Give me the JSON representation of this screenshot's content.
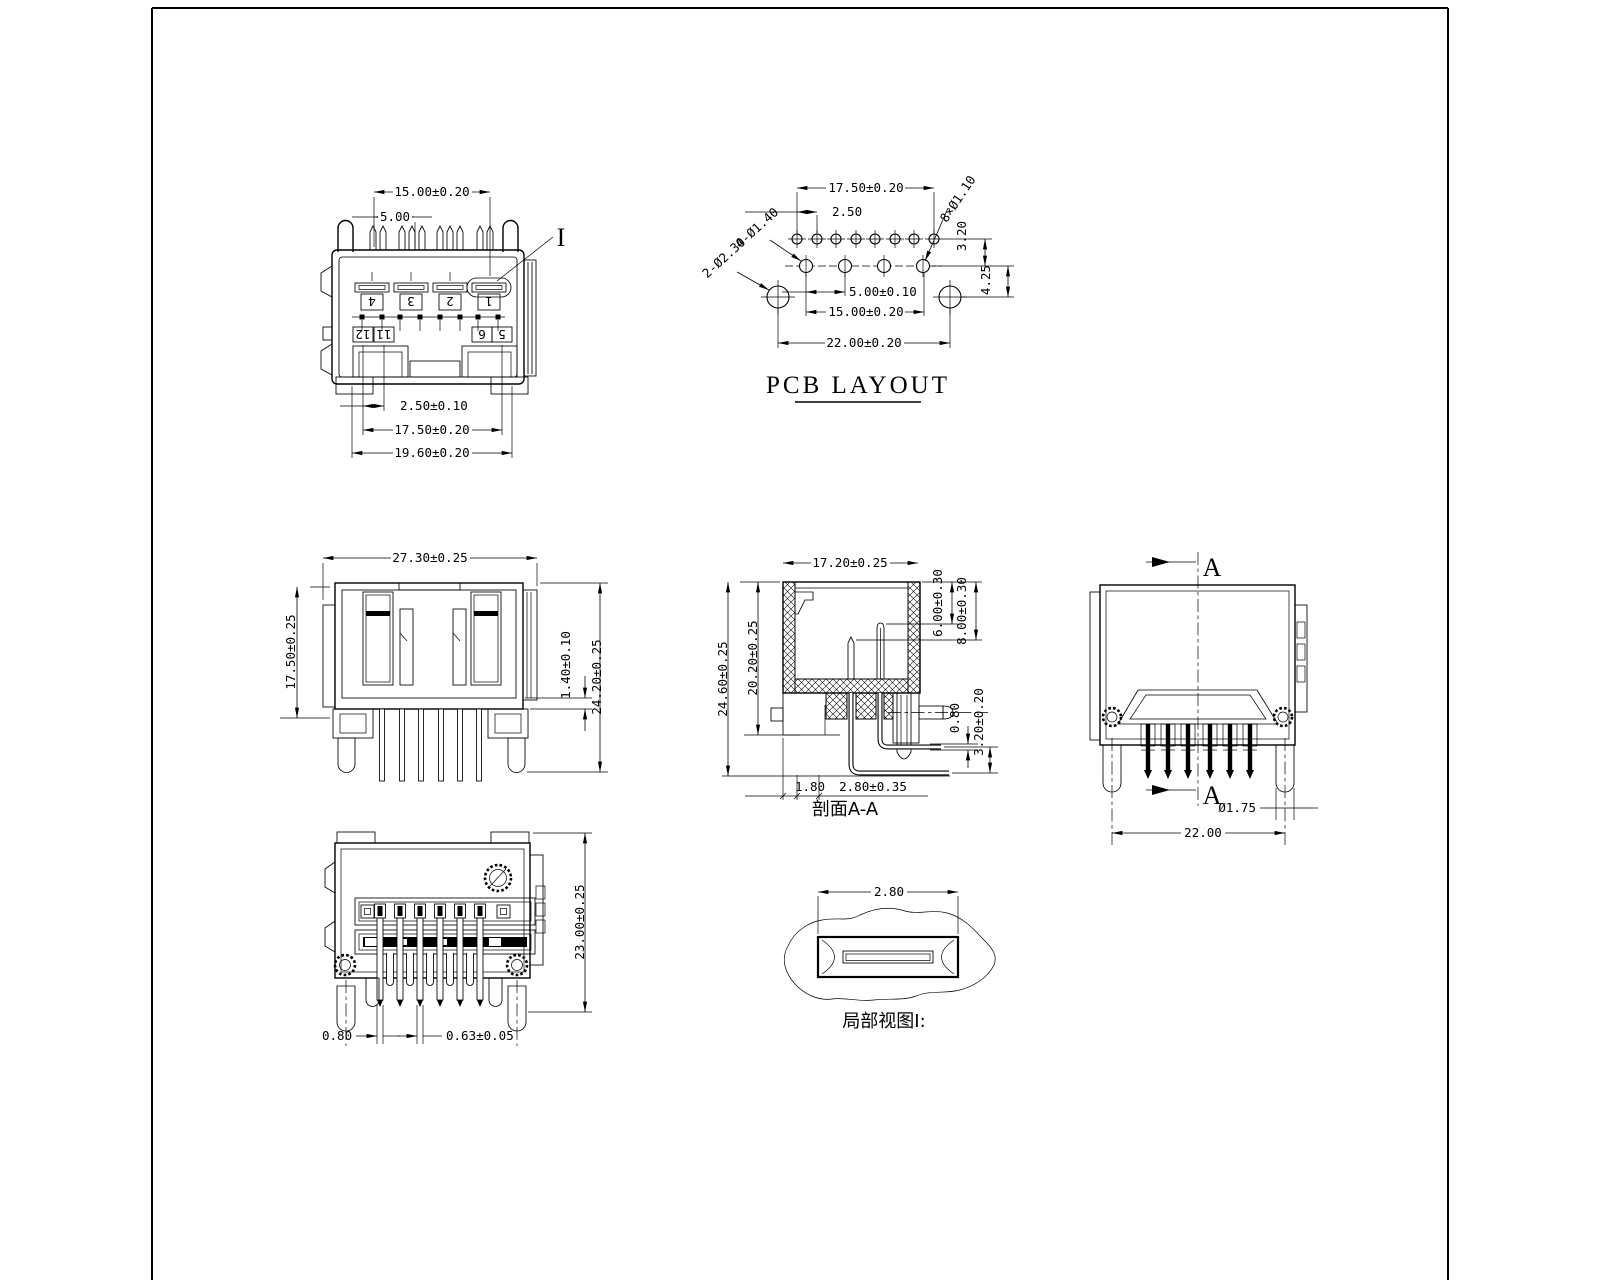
{
  "views": {
    "top_view": {
      "detail_label": "I",
      "dim_pin_span": "15.00±0.20",
      "dim_pin_pitch": "5.00",
      "dim_bottom_pitch": "2.50±0.10",
      "dim_bottom_span": "17.50±0.20",
      "dim_bottom_overall": "19.60±0.20",
      "pin_row_top": [
        "4",
        "3",
        "2",
        "1"
      ],
      "pin_row_bottom": [
        "12",
        "11",
        "6",
        "5"
      ]
    },
    "pcb_layout": {
      "title": "PCB LAYOUT",
      "dim_top_span": "17.50±0.20",
      "dim_top_pitch": "2.50",
      "hole_note_small": "8×Ø1.10",
      "dim_row_gap": "3.20",
      "hole_note_mid": "4-Ø1.40",
      "hole_note_big": "2-Ø2.30",
      "dim_mid_pitch": "5.00±0.10",
      "dim_mid_span": "15.00±0.20",
      "dim_big_offset": "4.25",
      "dim_big_span": "22.00±0.20"
    },
    "front_view": {
      "dim_width": "27.30±0.25",
      "dim_height_body": "17.50±0.25",
      "dim_lip": "1.40±0.10",
      "dim_height_overall": "24.20±0.25"
    },
    "section_view": {
      "caption": "剖面A-A",
      "dim_width": "17.20±0.25",
      "dim_pin_short": "6.00±0.30",
      "dim_pin_long": "8.00±0.30",
      "dim_height_overall": "24.60±0.25",
      "dim_height_body": "20.20±0.25",
      "dim_wire_dia": "0.80",
      "dim_wire_gap": "3.20±0.20",
      "dim_wall": "1.80",
      "dim_step": "2.80±0.35"
    },
    "side_view": {
      "cut_label": "A",
      "dim_peg_dia": "Ø1.75",
      "dim_peg_span": "22.00"
    },
    "rear_view": {
      "dim_height": "23.00±0.25",
      "dim_pin_a": "0.80",
      "dim_pin_b": "0.63±0.05"
    },
    "detail_view": {
      "caption": "局部视图I:",
      "dim_slot": "2.80"
    }
  }
}
